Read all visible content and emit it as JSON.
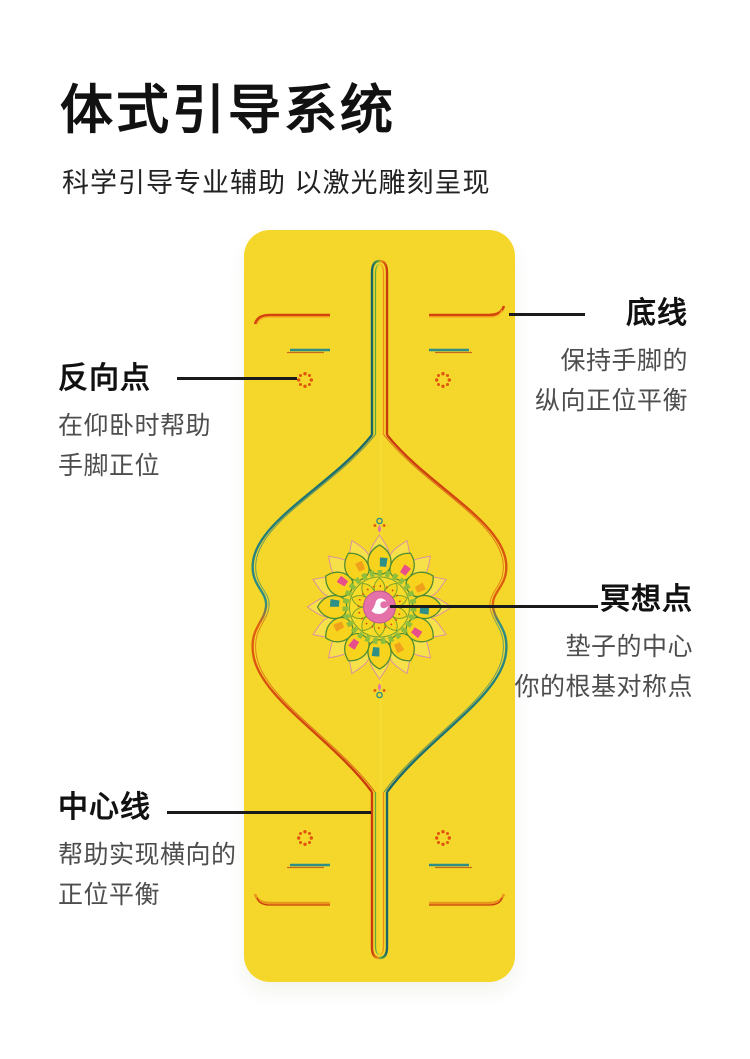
{
  "header": {
    "title": "体式引导系统",
    "subtitle": "科学引导专业辅助 以激光雕刻呈现"
  },
  "mat": {
    "description": "yellow yoga mat with laser-engraved alignment pattern",
    "engraving_elements": [
      "中心环线",
      "横向底线",
      "短标线",
      "反向点花标",
      "中央曼陀罗",
      "莲花中心标"
    ]
  },
  "callouts": [
    {
      "id": "bottom-line",
      "side": "right",
      "title": "底线",
      "desc": [
        "保持手脚的",
        "纵向正位平衡"
      ]
    },
    {
      "id": "reverse-point",
      "side": "left",
      "title": "反向点",
      "desc": [
        "在仰卧时帮助",
        "手脚正位"
      ]
    },
    {
      "id": "meditation-point",
      "side": "right",
      "title": "冥想点",
      "desc": [
        "垫子的中心",
        "你的根基对称点"
      ]
    },
    {
      "id": "center-line",
      "side": "left",
      "title": "中心线",
      "desc": [
        "帮助实现横向的",
        "正位平衡"
      ]
    }
  ],
  "colors": {
    "mat_yellow": "#F5D72B",
    "teal": "#1E7E78",
    "green": "#5FA73B",
    "orange": "#E8971B",
    "red": "#C9380E",
    "flower_orange": "#E0540E",
    "pink": "#E472A9",
    "text_dark": "#111111",
    "text_gray": "#4D4D4D",
    "line_black": "#1A1A1A",
    "page_bg": "#FFFFFF"
  }
}
